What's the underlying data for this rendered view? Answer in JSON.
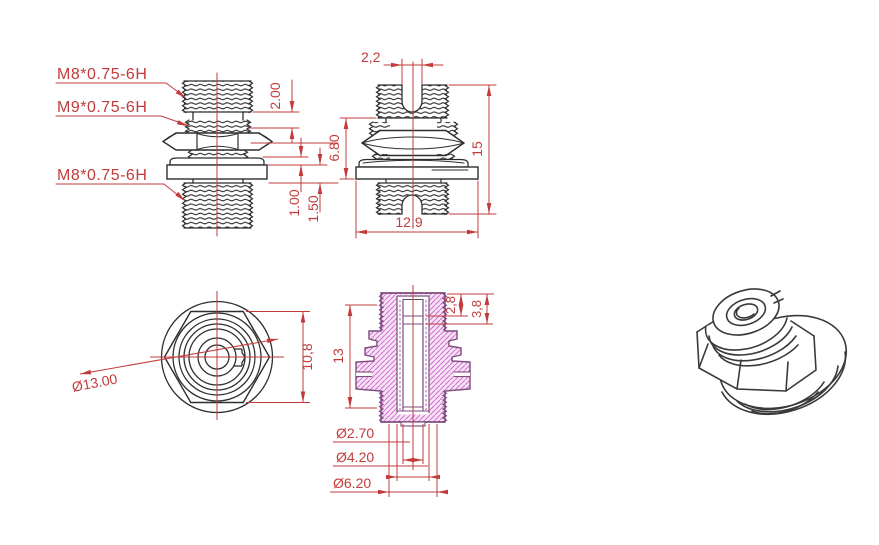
{
  "labels": {
    "thread_top": "M8*0.75-6H",
    "thread_mid": "M9*0.75-6H",
    "thread_bottom": "M8*0.75-6H"
  },
  "front_dims": {
    "neck_length": "2.00",
    "washer_thickness": "1.00",
    "flange_thickness": "1.50"
  },
  "side_dims": {
    "slot_width": "2,2",
    "mid_length": "6.80",
    "total_height": "15",
    "flange_width": "12,9"
  },
  "top_dims": {
    "outer_diameter": "Ø13.00",
    "across_flats": "10,8"
  },
  "section_dims": {
    "body_length": "13",
    "counterbore_depth_a": "2,8",
    "counterbore_depth_b": "3,8",
    "bore_diameter": "Ø2.70",
    "sleeve_diameter": "Ø4.20",
    "thread_minor_diameter": "Ø6.20"
  },
  "colors": {
    "dimension_red": "#c23b3b",
    "outline_dark": "#2e2e2e",
    "section_outline": "#7d4b7d",
    "hatch_line": "#cf6fcf",
    "hatch_fill": "#f8e3f6",
    "background": "#ffffff"
  }
}
